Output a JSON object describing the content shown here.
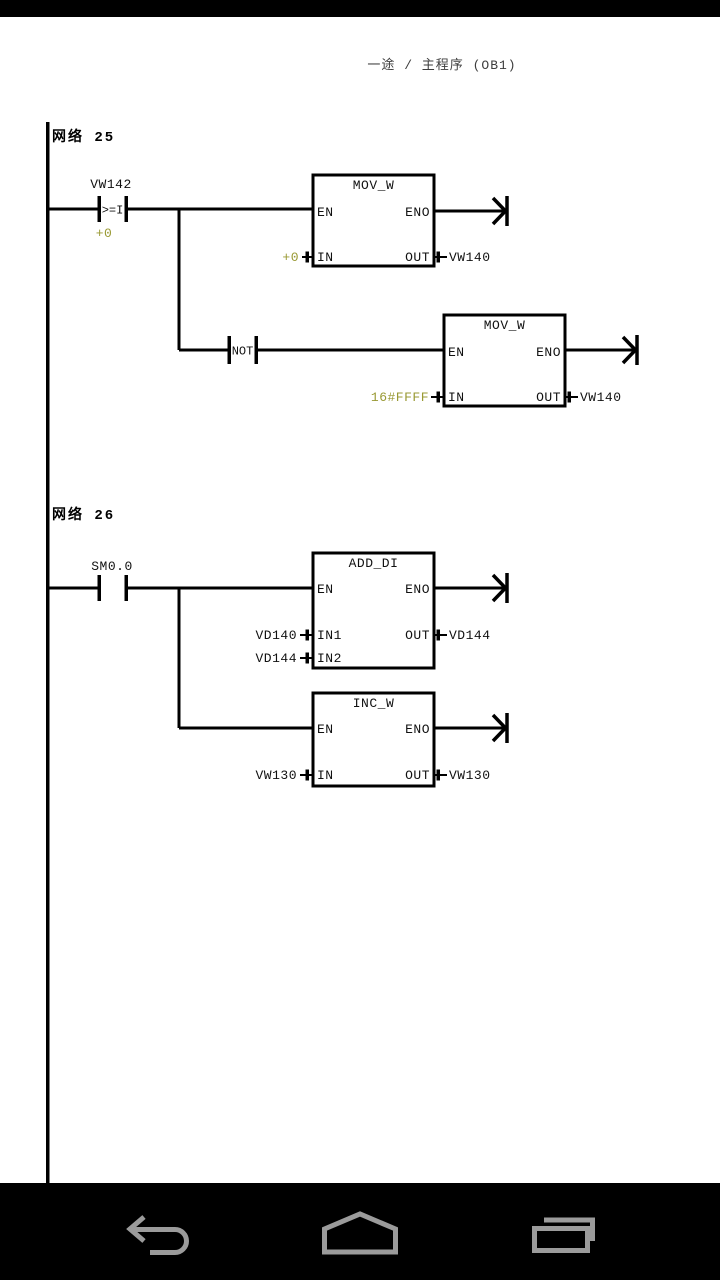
{
  "header": {
    "title": "一途 / 主程序 (OB1)"
  },
  "colors": {
    "line": "#000000",
    "value_text": "#999933",
    "background": "#ffffff",
    "bar_background": "#000000",
    "nav_icon": "#9b9b9b",
    "header_text": "#3d3d3d"
  },
  "networks": [
    {
      "label": "网络 25",
      "compare_contact": {
        "operand": "VW142",
        "symbol": ">=I",
        "value": "+0"
      },
      "mov_block_1": {
        "title": "MOV_W",
        "pins": {
          "en": "EN",
          "eno": "ENO",
          "in": "IN",
          "out": "OUT"
        },
        "in_value": "+0",
        "out_value": "VW140"
      },
      "not_contact": {
        "symbol": "NOT"
      },
      "mov_block_2": {
        "title": "MOV_W",
        "pins": {
          "en": "EN",
          "eno": "ENO",
          "in": "IN",
          "out": "OUT"
        },
        "in_value": "16#FFFF",
        "out_value": "VW140"
      }
    },
    {
      "label": "网络 26",
      "contact": {
        "operand": "SM0.0"
      },
      "add_block": {
        "title": "ADD_DI",
        "pins": {
          "en": "EN",
          "eno": "ENO",
          "in1": "IN1",
          "in2": "IN2",
          "out": "OUT"
        },
        "in1_value": "VD140",
        "in2_value": "VD144",
        "out_value": "VD144"
      },
      "inc_block": {
        "title": "INC_W",
        "pins": {
          "en": "EN",
          "eno": "ENO",
          "in": "IN",
          "out": "OUT"
        },
        "in_value": "VW130",
        "out_value": "VW130"
      }
    }
  ],
  "nav_bar": {
    "back": "back",
    "home": "home",
    "recents": "recents"
  }
}
